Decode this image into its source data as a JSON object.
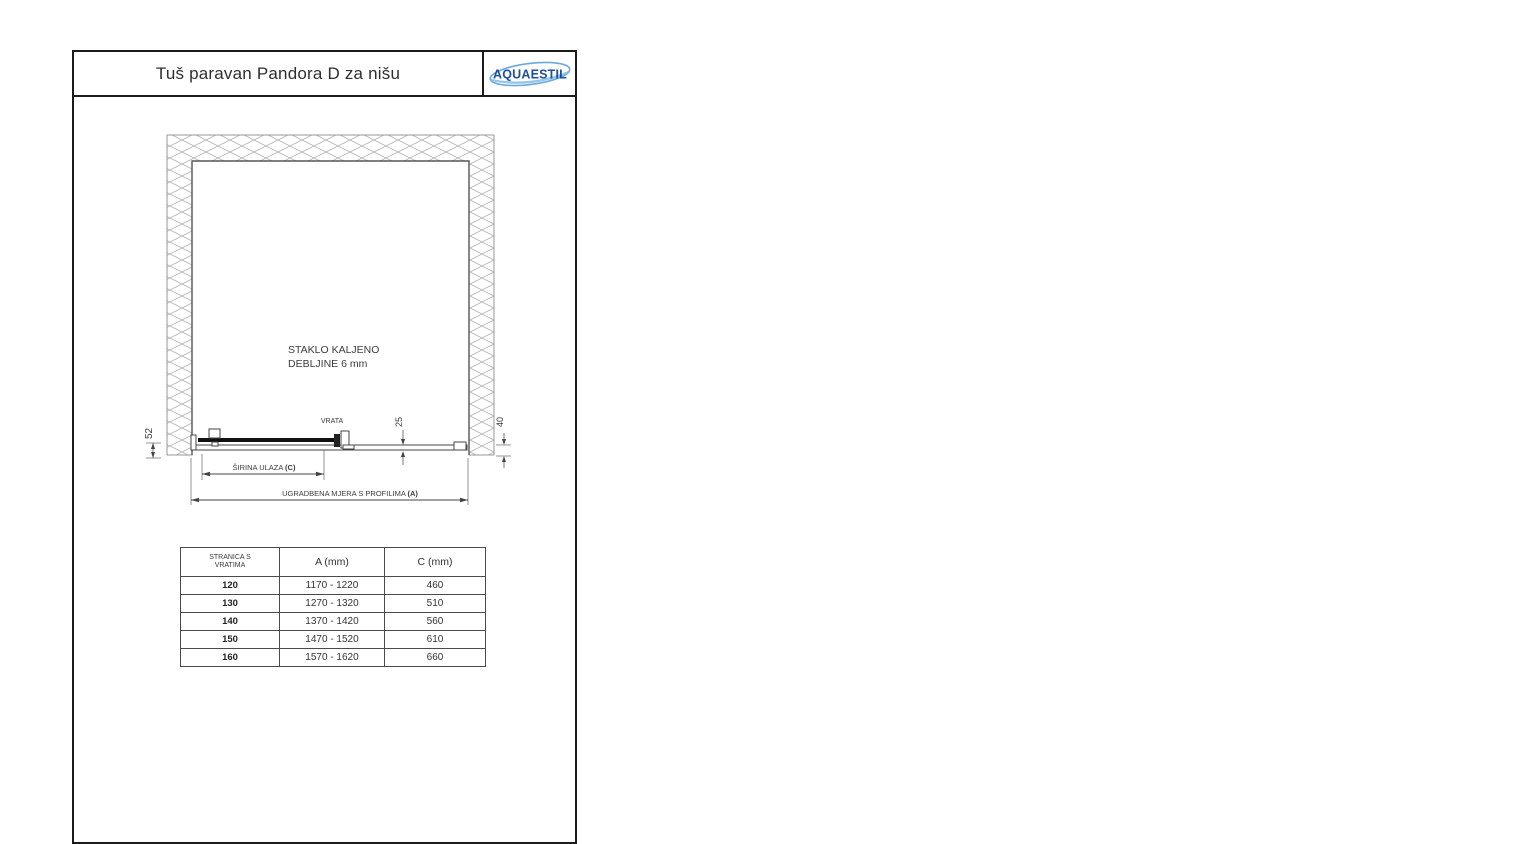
{
  "header": {
    "title": "Tuš paravan Pandora D za nišu",
    "logo": "AQUAESTIL"
  },
  "drawing": {
    "glass_line1": "STAKLO KALJENO",
    "glass_line2": "DEBLJINE 6 mm",
    "door_label": "VRATA",
    "dims": {
      "profile_height": "52",
      "track_offset": "25",
      "wall_gap": "40",
      "entry_width_label": "ŠIRINA ULAZA ",
      "entry_width_code": "(C)",
      "install_width_label": "UGRADBENA MJERA S PROFILIMA ",
      "install_width_code": "(A)"
    }
  },
  "table": {
    "headers": {
      "side_line1": "STRANICA S",
      "side_line2": "VRATIMA",
      "a": "A (mm)",
      "c": "C (mm)"
    },
    "rows": [
      {
        "size": "120",
        "a": "1170 - 1220",
        "c": "460"
      },
      {
        "size": "130",
        "a": "1270 - 1320",
        "c": "510"
      },
      {
        "size": "140",
        "a": "1370 - 1420",
        "c": "560"
      },
      {
        "size": "150",
        "a": "1470 - 1520",
        "c": "610"
      },
      {
        "size": "160",
        "a": "1570 - 1620",
        "c": "660"
      }
    ]
  },
  "colors": {
    "frame_line": "#1b1b1b",
    "drawing_line": "#444444",
    "hatch_line": "#b3b3b3",
    "logo_blue": "#1c4f9c",
    "swoosh_blue": "#5aa0d8"
  }
}
